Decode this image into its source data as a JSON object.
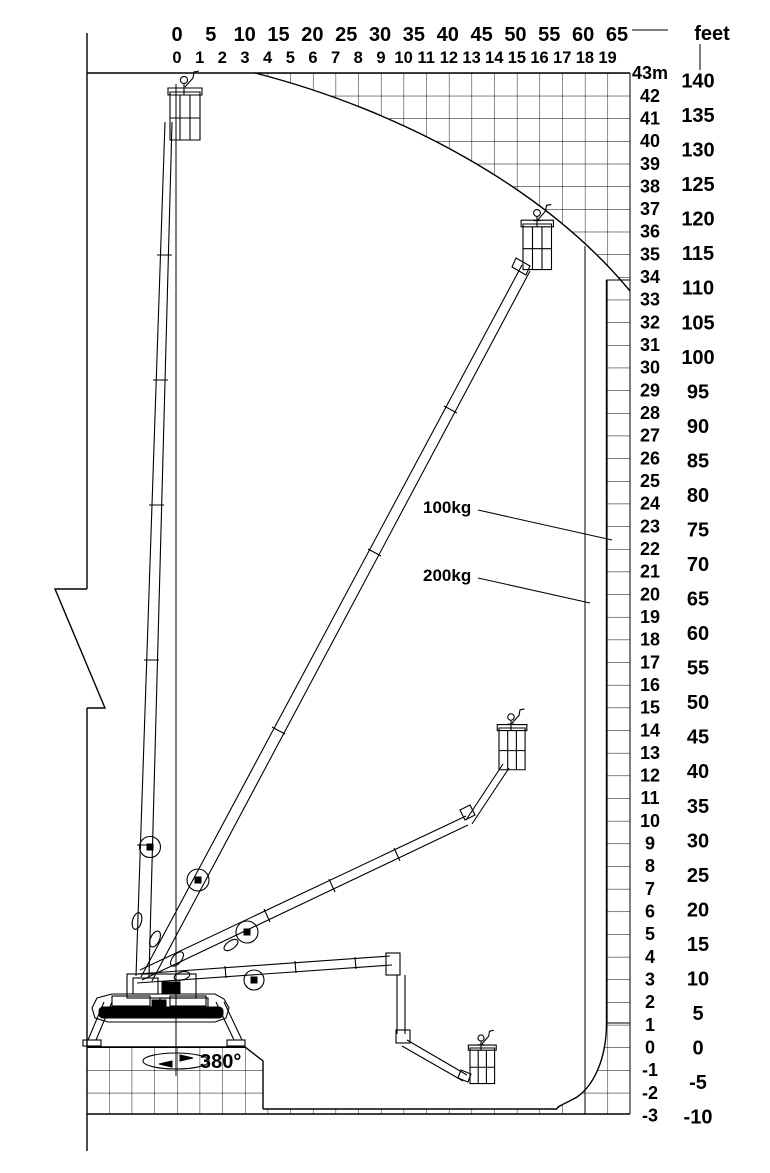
{
  "page": {
    "title": "Aerial work platform working envelope diagram"
  },
  "colors": {
    "ink": "#000000",
    "paper": "#ffffff"
  },
  "top_axis": {
    "feet_labels": [
      "0",
      "5",
      "10",
      "15",
      "20",
      "25",
      "30",
      "35",
      "40",
      "45",
      "50",
      "55",
      "60",
      "65"
    ],
    "unit_label": "feet",
    "meter_labels": [
      "0",
      "1",
      "2",
      "3",
      "4",
      "5",
      "6",
      "7",
      "8",
      "9",
      "10",
      "11",
      "12",
      "13",
      "14",
      "15",
      "16",
      "17",
      "18",
      "19"
    ]
  },
  "right_axis": {
    "meter_labels": [
      "43m",
      "42",
      "41",
      "40",
      "39",
      "38",
      "37",
      "36",
      "35",
      "34",
      "33",
      "32",
      "31",
      "30",
      "29",
      "28",
      "27",
      "26",
      "25",
      "24",
      "23",
      "22",
      "21",
      "20",
      "19",
      "18",
      "17",
      "16",
      "15",
      "14",
      "13",
      "12",
      "11",
      "10",
      "9",
      "8",
      "7",
      "6",
      "5",
      "4",
      "3",
      "2",
      "1",
      "0",
      "-1",
      "-2",
      "-3"
    ],
    "feet_labels": [
      "140",
      "135",
      "130",
      "125",
      "120",
      "115",
      "110",
      "105",
      "100",
      "95",
      "90",
      "85",
      "80",
      "75",
      "70",
      "65",
      "60",
      "55",
      "50",
      "45",
      "40",
      "35",
      "30",
      "25",
      "20",
      "15",
      "10",
      "5",
      "0",
      "-5",
      "-10"
    ]
  },
  "capacity_labels": {
    "outer": "100kg",
    "inner": "200kg"
  },
  "rotation_label": "380°",
  "chart_data": {
    "type": "area",
    "title": "Boom lift reach envelope",
    "x_axis": {
      "label": "feet",
      "feet_ticks": [
        0,
        5,
        10,
        15,
        20,
        25,
        30,
        35,
        40,
        45,
        50,
        55,
        60,
        65
      ],
      "meter_ticks": [
        0,
        1,
        2,
        3,
        4,
        5,
        6,
        7,
        8,
        9,
        10,
        11,
        12,
        13,
        14,
        15,
        16,
        17,
        18,
        19
      ]
    },
    "y_axis": {
      "meter_ticks_top_to_bottom": [
        43,
        42,
        41,
        40,
        39,
        38,
        37,
        36,
        35,
        34,
        33,
        32,
        31,
        30,
        29,
        28,
        27,
        26,
        25,
        24,
        23,
        22,
        21,
        20,
        19,
        18,
        17,
        16,
        15,
        14,
        13,
        12,
        11,
        10,
        9,
        8,
        7,
        6,
        5,
        4,
        3,
        2,
        1,
        0,
        -1,
        -2,
        -3
      ],
      "feet_ticks_top_to_bottom": [
        140,
        135,
        130,
        125,
        120,
        115,
        110,
        105,
        100,
        95,
        90,
        85,
        80,
        75,
        70,
        65,
        60,
        55,
        50,
        45,
        40,
        35,
        30,
        25,
        20,
        15,
        10,
        5,
        0,
        -5,
        -10
      ]
    },
    "max_height_m": 43,
    "max_height_ft": 140,
    "max_outreach_m": 19,
    "min_depth_m": -3,
    "grid_cell_m": 1,
    "capacity_zones": [
      {
        "label": "100kg",
        "boundary": "outer envelope"
      },
      {
        "label": "200kg",
        "boundary": "inner envelope (approx 18 m outreach)"
      }
    ],
    "slew_range": "380°",
    "envelope_outline_m": [
      [
        0,
        43
      ],
      [
        3.4,
        43
      ],
      [
        7.5,
        41.5
      ],
      [
        11,
        39.5
      ],
      [
        14.5,
        37
      ],
      [
        18,
        35.2
      ],
      [
        19,
        34
      ],
      [
        19,
        1
      ],
      [
        18.3,
        -1
      ],
      [
        16.8,
        -2.9
      ],
      [
        3.8,
        -2.9
      ],
      [
        3.8,
        -0.6
      ],
      [
        3,
        0
      ],
      [
        0,
        0
      ]
    ],
    "boom_positions_shown": [
      {
        "pose": "fully raised vertical",
        "basket_at_m": [
          0.5,
          42
        ]
      },
      {
        "pose": "raised ~62°",
        "basket_at_m": [
          16,
          35.5
        ]
      },
      {
        "pose": "mid elevation with jib up",
        "basket_at_m": [
          14.6,
          13.5
        ]
      },
      {
        "pose": "horizontal with jib below grade",
        "basket_at_m": [
          13.5,
          -0.7
        ]
      }
    ]
  }
}
